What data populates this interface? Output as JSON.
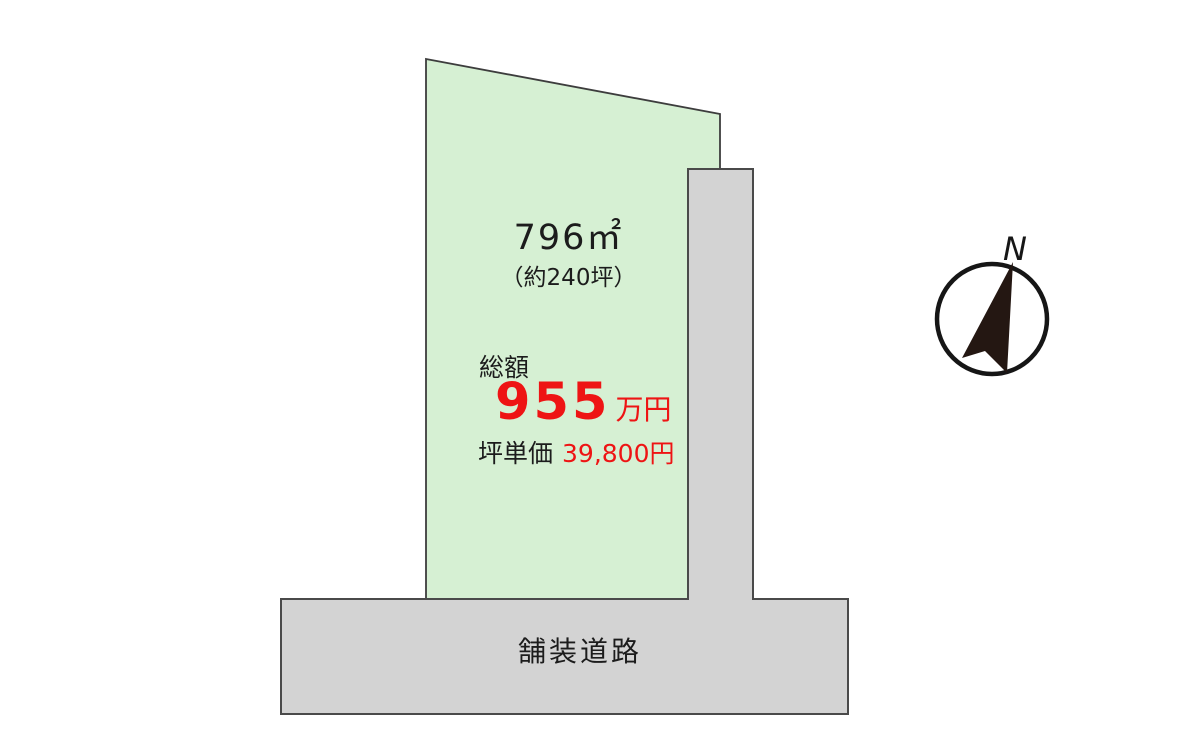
{
  "parcel": {
    "area": "796㎡",
    "area_tsubo": "（約240坪）",
    "price_label": "総額",
    "price_amount": "955",
    "price_unit": "万円",
    "tsubo_price_label": "坪単価",
    "tsubo_price_value": "39,800円"
  },
  "road": {
    "label": "舗装道路"
  },
  "compass": {
    "north_label": "N"
  },
  "colors": {
    "parcel_fill": "#d6f0d3",
    "road_fill": "#d3d3d3",
    "outline_dark": "#4a4a4a",
    "price_red": "#ee1414",
    "text_dark": "#1c1c1c",
    "compass_arrow": "#241712"
  }
}
